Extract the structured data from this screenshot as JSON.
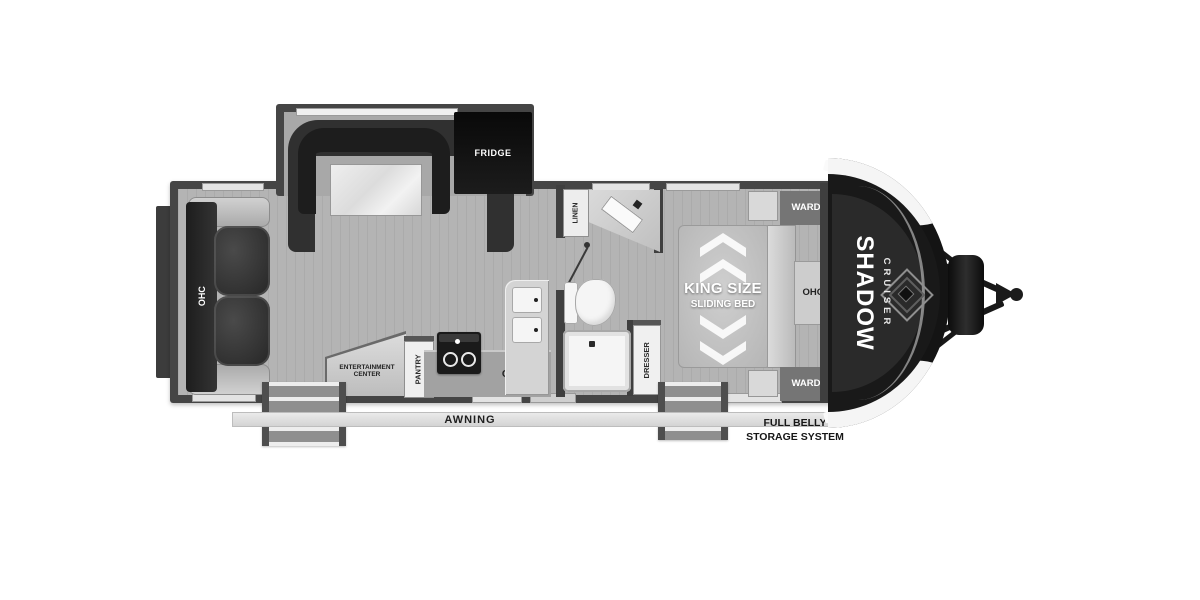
{
  "floorplan": {
    "brand": {
      "shadow": "SHADOW",
      "cruiser": "CRUISER"
    },
    "living": {
      "sofa_ohc": "OHC",
      "fridge": "FRIDGE",
      "entertainment_line1": "ENTERTAINMENT",
      "entertainment_line2": "CENTER"
    },
    "kitchen": {
      "pantry": "PANTRY",
      "ohc": "OHC"
    },
    "bath": {
      "linen": "LINEN"
    },
    "bedroom": {
      "bed_line1": "KING SIZE",
      "bed_line2": "SLIDING BED",
      "dresser": "DRESSER",
      "ward_top": "WARD",
      "ward_bottom": "WARD",
      "ohc": "OHC"
    },
    "exterior": {
      "awning": "AWNING",
      "belly_line1": "FULL BELLY",
      "belly_line2": "STORAGE SYSTEM"
    },
    "colors": {
      "floor": "#b4b4b4",
      "wall": "#3f3f3f",
      "slide_floor": "#a8a8a8",
      "dark_furniture": "#2b2b2b",
      "counter": "#d4d4d4",
      "fixture": "#f5f5f5",
      "front_cap": "#141414",
      "mattress": "#c3c3c3",
      "cabinet_gray": "#757575"
    }
  }
}
